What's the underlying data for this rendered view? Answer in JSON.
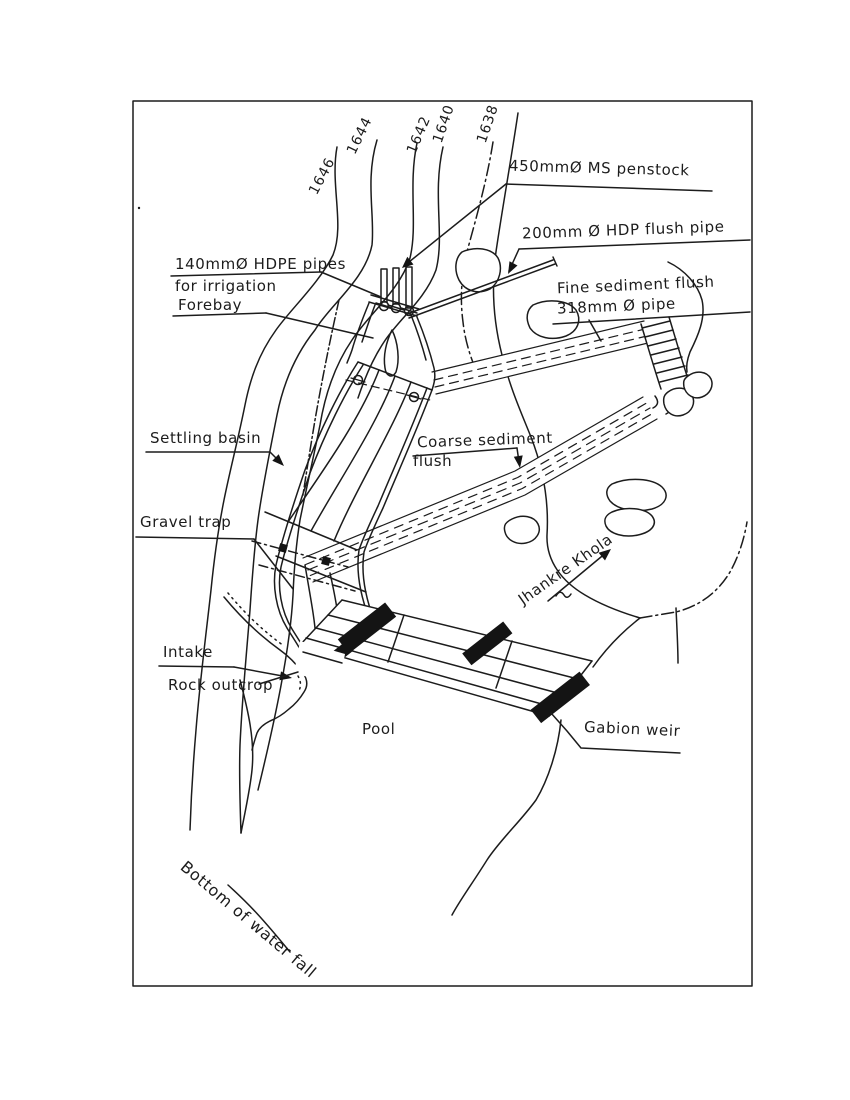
{
  "drawing": {
    "labels": {
      "penstock": "450mmØ MS penstock",
      "flush_pipe": "200mm Ø HDP flush pipe",
      "hdpe_line1": "140mmØ HDPE pipes",
      "hdpe_line2": "for irrigation",
      "forebay": "Forebay",
      "fine_flush_line1": "Fine sediment flush",
      "fine_flush_line2": "318mm Ø pipe",
      "settling_basin": "Settling basin",
      "coarse_line1": "Coarse sediment",
      "coarse_line2": "flush",
      "gravel_trap": "Gravel trap",
      "intake": "Intake",
      "rock_outcrop": "Rock outcrop",
      "pool": "Pool",
      "gabion_weir": "Gabion weir",
      "river": "Jhankre Khola",
      "waterfall": "Bottom of water fall"
    },
    "contours": [
      "1646",
      "1644",
      "1642",
      "1640",
      "1638"
    ],
    "ink_color": "#1c1c1c",
    "paper_color": "#ffffff"
  }
}
